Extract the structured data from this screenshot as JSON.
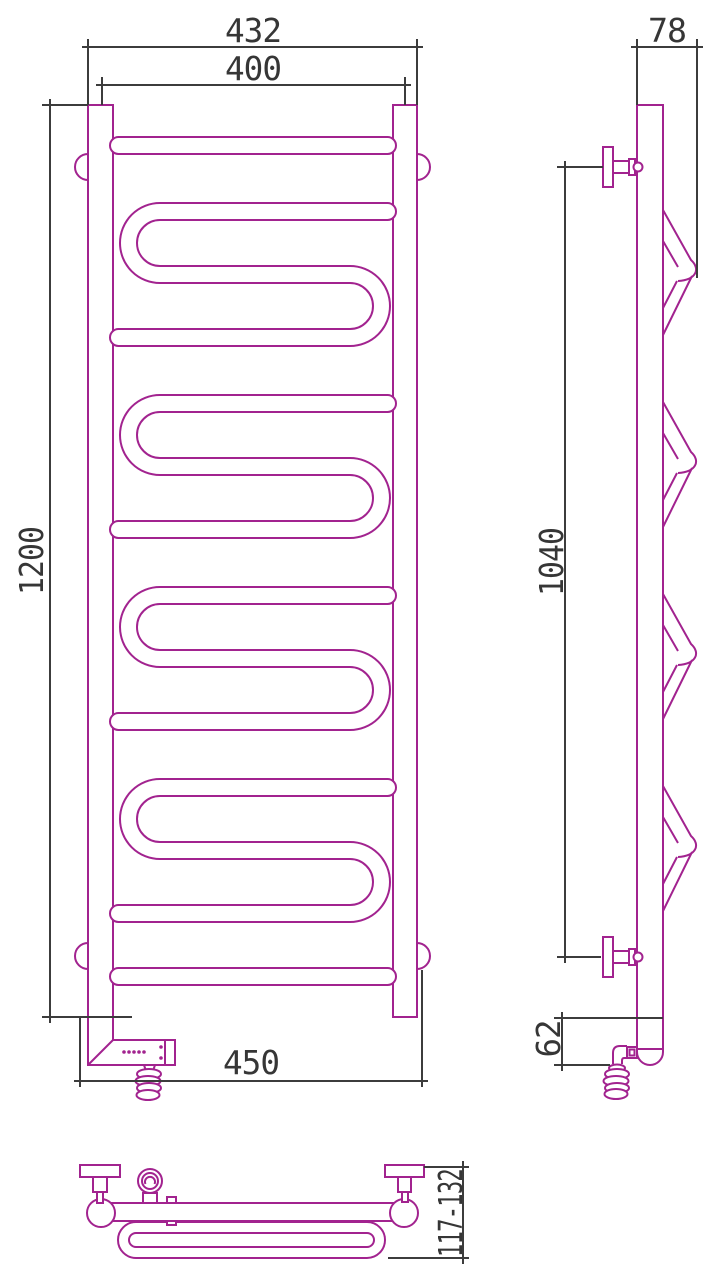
{
  "drawing": {
    "title": "heated-towel-rail-technical-drawing",
    "colors": {
      "outline": "#A2238F",
      "dimension": "#3C3C3C",
      "dimension_text": "#363636",
      "background": "#FFFFFF"
    },
    "views": {
      "front": "front view with serpentine coils, two vertical collectors, heating element box with coiled power cable",
      "side": "side profile with wall brackets and four coil hooks",
      "top": "top view with wall brackets, ball joints, thermostat head and coil loop"
    },
    "dimensions": {
      "front": {
        "overall_width": "432",
        "center_width": "400",
        "overall_height": "1200",
        "bottom_width": "450"
      },
      "side": {
        "depth": "78",
        "bracket_span": "1040",
        "bottom_offset": "62"
      },
      "top": {
        "wall_clearance": "117-132"
      }
    }
  }
}
